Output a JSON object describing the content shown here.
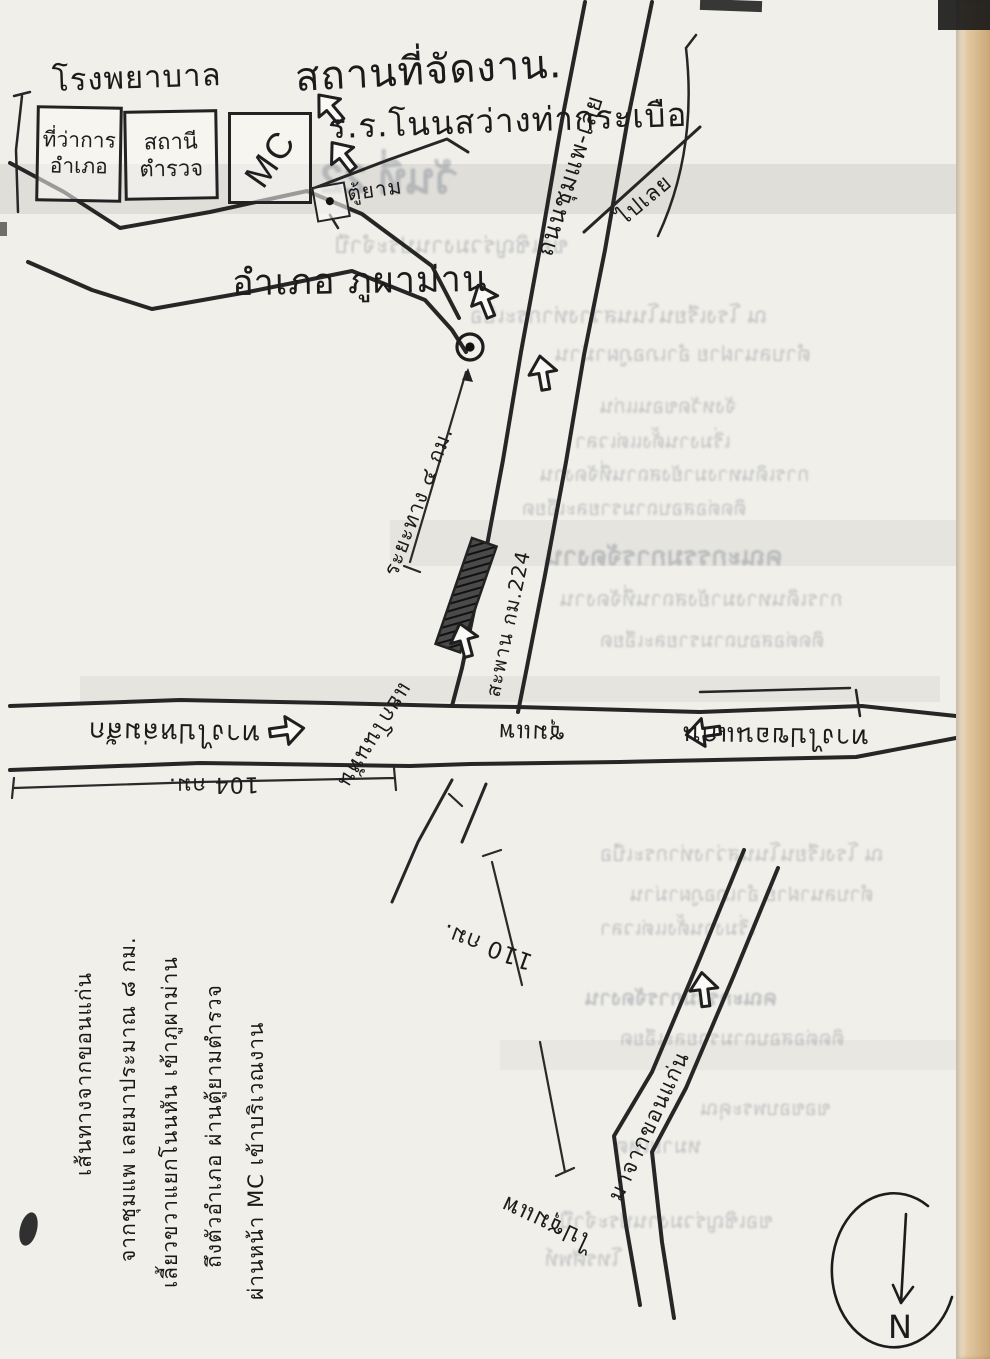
{
  "page": {
    "kind": "scanned hand-drawn direction map",
    "paper_color": "#f1efe9",
    "ink_color": "#232323",
    "edge_color": "#caa878"
  },
  "venue": {
    "title": "สถานที่จัดงาน.",
    "school": "ร.ร.โนนสว่างท่ากระเบือ"
  },
  "town": {
    "hospital": "โรงพยาบาล",
    "district_office_line1": "ที่ว่าการ",
    "district_office_line2": "อำเภอ",
    "police_line1": "สถานี",
    "police_line2": "ตำรวจ",
    "mc": "MC",
    "guard_post": "ตู้ยาม",
    "district_label": "อำเภอ ภูผาม่าน"
  },
  "roads": {
    "highway_name": "ถนนชุมแพ-เลย",
    "to_loei": "ไปเลย",
    "left_direction": "ทางไปหล่มสัก",
    "right_direction": "ทางไปขอนแก่น",
    "chumphae": "ชุมแพ",
    "junction": "แยกโนนหัน",
    "bridge": "สะพาน กม.224",
    "access_note": "ระยะทาง ๔ กม.",
    "from_khonkaen": "มาจากขอนแก่น",
    "to_chumphae": "ไปชุมแพ"
  },
  "distances": {
    "d104": "104 กม.",
    "d110": "110 กม."
  },
  "notes": {
    "n1": "ผ่านหน้า MC เข้าบริเวณงาน",
    "n2": "ถึงตัวอำเภอ ผ่านตู้ยามตำรวจ",
    "n3": "เลี้ยวขวาแยกโนนหัน เข้าภูผาม่าน",
    "n4": "จากชุมแพ เลยมาประมาณ ๘ กม.",
    "n5": "เส้นทางจากขอนแก่น"
  },
  "compass": {
    "label": "N"
  },
  "ghost": {
    "g1": "วันที่ 22",
    "g2": "ขอเชิญร่วมงานประจำปี",
    "g3": "ณ โรงเรียนโนนสว่างท่ากระเบือ",
    "g4": "ตำบลนาฝาย อำเภอภูผาม่าน",
    "g5": "จังหวัดขอนแก่น",
    "g6": "เริ่มงานตั้งแต่เวลา",
    "g7": "การเดินทางมายังสถานที่จัดงาน",
    "g8": "ติดต่อสอบถามรายละเอียด",
    "g9": "คณะกรรมการจัดงาน",
    "g10": "ขอขอบพระคุณ",
    "g11": "หมายเหตุ",
    "g12": "โทรศัพท์"
  }
}
